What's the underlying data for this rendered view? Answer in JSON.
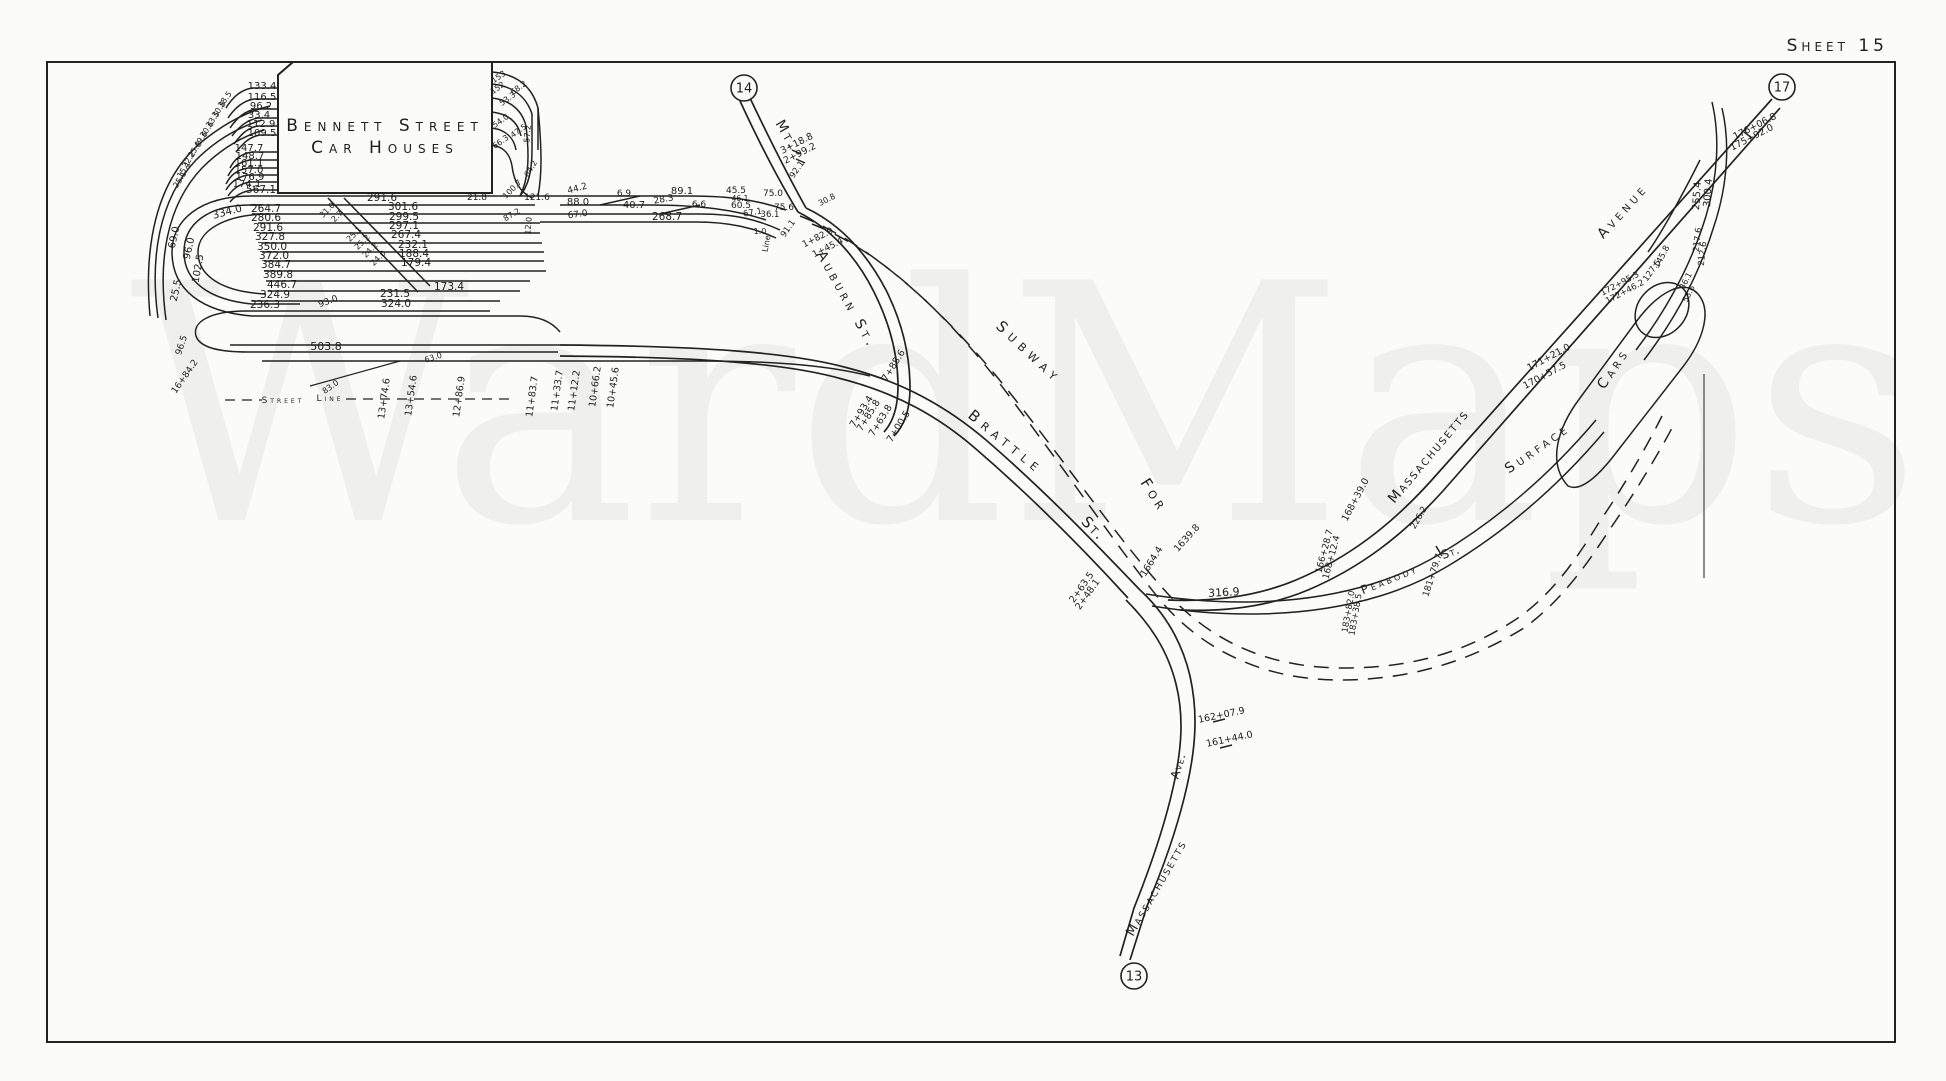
{
  "sheet": {
    "title": "Sheet 15"
  },
  "watermark": {
    "text": "WardMaps"
  },
  "building": {
    "line1": "Bennett Street",
    "line2": "Car Houses"
  },
  "colors": {
    "ink": "#222222",
    "paper": "#fbfbf9"
  },
  "ref_circles": [
    {
      "label": "14",
      "x": 744,
      "y": 88
    },
    {
      "label": "17",
      "x": 1782,
      "y": 87
    },
    {
      "label": "13",
      "x": 1134,
      "y": 976
    }
  ],
  "street_labels": [
    {
      "text": "Mt.",
      "x": 783,
      "y": 137,
      "r": 60,
      "s": 14,
      "ls": 3
    },
    {
      "text": "Auburn St.",
      "x": 843,
      "y": 302,
      "r": 61,
      "s": 14,
      "ls": 4
    },
    {
      "text": "Brattle",
      "x": 1003,
      "y": 446,
      "r": 39,
      "s": 15,
      "ls": 6
    },
    {
      "text": "St.",
      "x": 1090,
      "y": 532,
      "r": 45,
      "s": 15,
      "ls": 2
    },
    {
      "text": "Subway",
      "x": 1026,
      "y": 356,
      "r": 43,
      "s": 15,
      "ls": 6
    },
    {
      "text": "For",
      "x": 1150,
      "y": 498,
      "r": 57,
      "s": 15,
      "ls": 4
    },
    {
      "text": "Massachusetts",
      "x": 1432,
      "y": 459,
      "r": -50,
      "s": 14,
      "ls": 2
    },
    {
      "text": "Avenue",
      "x": 1626,
      "y": 214,
      "r": -48,
      "s": 14,
      "ls": 4
    },
    {
      "text": "Surface",
      "x": 1540,
      "y": 452,
      "r": -35,
      "s": 14,
      "ls": 4
    },
    {
      "text": "Cars",
      "x": 1617,
      "y": 371,
      "r": -56,
      "s": 14,
      "ls": 4
    },
    {
      "text": "Peabody",
      "x": 1391,
      "y": 583,
      "r": -22,
      "s": 12,
      "ls": 3
    },
    {
      "text": "St.",
      "x": 1452,
      "y": 556,
      "r": -20,
      "s": 12,
      "ls": 1
    },
    {
      "text": "Massachusetts",
      "x": 1160,
      "y": 890,
      "r": -60,
      "s": 13,
      "ls": 2
    },
    {
      "text": "Ave.",
      "x": 1182,
      "y": 767,
      "r": -73,
      "s": 12,
      "ls": 1
    },
    {
      "text": "Street",
      "x": 283,
      "y": 403,
      "r": 0,
      "s": 9,
      "ls": 3
    },
    {
      "text": "Line",
      "x": 330,
      "y": 401,
      "r": 0,
      "s": 9,
      "ls": 3
    }
  ],
  "measurements": [
    {
      "t": "49.6",
      "x": 203,
      "y": 141,
      "r": -55,
      "s": 8
    },
    {
      "t": "30.6",
      "x": 209,
      "y": 131,
      "r": -55,
      "s": 8
    },
    {
      "t": "33.5",
      "x": 215,
      "y": 121,
      "r": -55,
      "s": 8
    },
    {
      "t": "30.8",
      "x": 221,
      "y": 111,
      "r": -55,
      "s": 8
    },
    {
      "t": "38.5",
      "x": 227,
      "y": 101,
      "r": -55,
      "s": 8
    },
    {
      "t": "25.8",
      "x": 197,
      "y": 151,
      "r": -55,
      "s": 8
    },
    {
      "t": "22.2",
      "x": 191,
      "y": 161,
      "r": -58,
      "s": 8
    },
    {
      "t": "15.1",
      "x": 186,
      "y": 171,
      "r": -58,
      "s": 8
    },
    {
      "t": "25.1",
      "x": 182,
      "y": 181,
      "r": -58,
      "s": 8
    },
    {
      "t": "133.4",
      "x": 262,
      "y": 89,
      "s": 10
    },
    {
      "t": "116.5",
      "x": 262,
      "y": 100,
      "s": 10
    },
    {
      "t": "96.2",
      "x": 261,
      "y": 109,
      "s": 10
    },
    {
      "t": "33.4",
      "x": 259,
      "y": 118,
      "s": 10
    },
    {
      "t": "112.9",
      "x": 261,
      "y": 127,
      "s": 10
    },
    {
      "t": "109.5",
      "x": 262,
      "y": 136,
      "s": 10
    },
    {
      "t": "147.7",
      "x": 249,
      "y": 151,
      "s": 10
    },
    {
      "t": "148.7",
      "x": 250,
      "y": 159,
      "s": 10
    },
    {
      "t": "161.1",
      "x": 249,
      "y": 166,
      "s": 10
    },
    {
      "t": "157.0",
      "x": 249,
      "y": 173,
      "s": 10
    },
    {
      "t": "176.9",
      "x": 250,
      "y": 180,
      "s": 10
    },
    {
      "t": "174.1",
      "x": 247,
      "y": 187,
      "s": 10
    },
    {
      "t": "567.1",
      "x": 261,
      "y": 193,
      "s": 10.5
    },
    {
      "t": "291.6",
      "x": 382,
      "y": 201,
      "s": 10.5
    },
    {
      "t": "21.8",
      "x": 477,
      "y": 200,
      "s": 9
    },
    {
      "t": "334.0",
      "x": 228,
      "y": 215,
      "r": -15,
      "s": 10.5
    },
    {
      "t": "264.7",
      "x": 266,
      "y": 212,
      "s": 10.5
    },
    {
      "t": "280.6",
      "x": 266,
      "y": 221,
      "s": 10.5
    },
    {
      "t": "291.6",
      "x": 268,
      "y": 231,
      "s": 10.5
    },
    {
      "t": "327.8",
      "x": 270,
      "y": 240,
      "s": 10.5
    },
    {
      "t": "350.0",
      "x": 272,
      "y": 250,
      "s": 10.5
    },
    {
      "t": "372.0",
      "x": 274,
      "y": 259,
      "s": 10.5
    },
    {
      "t": "384.7",
      "x": 276,
      "y": 268,
      "s": 10.5
    },
    {
      "t": "389.8",
      "x": 278,
      "y": 278,
      "s": 10.5
    },
    {
      "t": "446.7",
      "x": 282,
      "y": 288,
      "s": 10.5
    },
    {
      "t": "324.9",
      "x": 275,
      "y": 298,
      "s": 10.5
    },
    {
      "t": "236.3",
      "x": 265,
      "y": 308,
      "s": 10.5
    },
    {
      "t": "301.6",
      "x": 403,
      "y": 210,
      "s": 10.5
    },
    {
      "t": "299.5",
      "x": 404,
      "y": 220,
      "s": 10.5
    },
    {
      "t": "297.1",
      "x": 404,
      "y": 229,
      "s": 10.5
    },
    {
      "t": "267.4",
      "x": 406,
      "y": 238,
      "s": 10.5
    },
    {
      "t": "232.1",
      "x": 413,
      "y": 248,
      "s": 10.5
    },
    {
      "t": "188.4",
      "x": 414,
      "y": 257,
      "s": 10.5
    },
    {
      "t": "179.4",
      "x": 416,
      "y": 266,
      "s": 10.5
    },
    {
      "t": "173.4",
      "x": 449,
      "y": 290,
      "s": 10.5
    },
    {
      "t": "231.5",
      "x": 395,
      "y": 297,
      "s": 10.5
    },
    {
      "t": "324.0",
      "x": 396,
      "y": 307,
      "s": 10.5
    },
    {
      "t": "31.0",
      "x": 329,
      "y": 212,
      "r": -45,
      "s": 8
    },
    {
      "t": "2.7",
      "x": 339,
      "y": 218,
      "r": -45,
      "s": 8
    },
    {
      "t": "25.1",
      "x": 356,
      "y": 236,
      "r": -45,
      "s": 8
    },
    {
      "t": "25.2",
      "x": 364,
      "y": 244,
      "r": -45,
      "s": 8
    },
    {
      "t": "24.2",
      "x": 372,
      "y": 252,
      "r": -45,
      "s": 8
    },
    {
      "t": "24.0",
      "x": 380,
      "y": 260,
      "r": -45,
      "s": 8
    },
    {
      "t": "93.0",
      "x": 329,
      "y": 304,
      "r": -20,
      "s": 9
    },
    {
      "t": "69.0",
      "x": 177,
      "y": 238,
      "r": -78,
      "s": 10
    },
    {
      "t": "96.0",
      "x": 192,
      "y": 249,
      "r": -78,
      "s": 10
    },
    {
      "t": "102.5",
      "x": 201,
      "y": 269,
      "r": -80,
      "s": 10
    },
    {
      "t": "25.5",
      "x": 179,
      "y": 291,
      "r": -78,
      "s": 10
    },
    {
      "t": "96.5",
      "x": 184,
      "y": 346,
      "r": -72,
      "s": 9
    },
    {
      "t": "16+84.2",
      "x": 187,
      "y": 378,
      "r": -55,
      "s": 9
    },
    {
      "t": "503.8",
      "x": 326,
      "y": 350,
      "s": 11
    },
    {
      "t": "83.0",
      "x": 332,
      "y": 389,
      "r": -35,
      "s": 8
    },
    {
      "t": "63.0",
      "x": 434,
      "y": 360,
      "r": -18,
      "s": 8
    },
    {
      "t": "13+74.6",
      "x": 387,
      "y": 399,
      "r": -82,
      "s": 9.5
    },
    {
      "t": "13+54.6",
      "x": 414,
      "y": 396,
      "r": -82,
      "s": 9.5
    },
    {
      "t": "12+86.9",
      "x": 462,
      "y": 397,
      "r": -82,
      "s": 9.5
    },
    {
      "t": "11+83.7",
      "x": 535,
      "y": 397,
      "r": -82,
      "s": 9.5
    },
    {
      "t": "11+33.7",
      "x": 560,
      "y": 391,
      "r": -82,
      "s": 9.5
    },
    {
      "t": "11+12.2",
      "x": 577,
      "y": 391,
      "r": -82,
      "s": 9.5
    },
    {
      "t": "10+66.2",
      "x": 598,
      "y": 387,
      "r": -82,
      "s": 9.5
    },
    {
      "t": "10+45.6",
      "x": 616,
      "y": 388,
      "r": -82,
      "s": 9.5
    },
    {
      "t": "153",
      "x": 500,
      "y": 79,
      "r": -35,
      "s": 8
    },
    {
      "t": "152",
      "x": 499,
      "y": 90,
      "r": -35,
      "s": 8
    },
    {
      "t": "68.2",
      "x": 520,
      "y": 90,
      "r": -35,
      "s": 8
    },
    {
      "t": "53.3",
      "x": 509,
      "y": 101,
      "r": -35,
      "s": 8
    },
    {
      "t": "54.0",
      "x": 502,
      "y": 123,
      "r": -35,
      "s": 8
    },
    {
      "t": "47.5",
      "x": 520,
      "y": 133,
      "r": -35,
      "s": 8
    },
    {
      "t": "66.3",
      "x": 502,
      "y": 144,
      "r": -35,
      "s": 8
    },
    {
      "t": "57.2",
      "x": 530,
      "y": 134,
      "r": -85,
      "s": 8
    },
    {
      "t": "64.2",
      "x": 533,
      "y": 170,
      "r": -60,
      "s": 8
    },
    {
      "t": "100.7",
      "x": 514,
      "y": 191,
      "r": -45,
      "s": 8
    },
    {
      "t": "121.6",
      "x": 537,
      "y": 200,
      "s": 9
    },
    {
      "t": "87.2",
      "x": 513,
      "y": 217,
      "r": -30,
      "s": 8
    },
    {
      "t": "12.0",
      "x": 531,
      "y": 226,
      "r": -85,
      "s": 8
    },
    {
      "t": "44.2",
      "x": 578,
      "y": 191,
      "r": -15,
      "s": 9
    },
    {
      "t": "6.9",
      "x": 624,
      "y": 196,
      "s": 9
    },
    {
      "t": "89.1",
      "x": 682,
      "y": 194,
      "s": 10
    },
    {
      "t": "88.0",
      "x": 578,
      "y": 205,
      "s": 10
    },
    {
      "t": "40.7",
      "x": 634,
      "y": 208,
      "s": 10
    },
    {
      "t": "28.3",
      "x": 664,
      "y": 202,
      "r": -10,
      "s": 9
    },
    {
      "t": "6.6",
      "x": 699,
      "y": 207,
      "s": 9
    },
    {
      "t": "268.7",
      "x": 667,
      "y": 220,
      "s": 10.5
    },
    {
      "t": "67.0",
      "x": 578,
      "y": 217,
      "r": -8,
      "s": 9
    },
    {
      "t": "45.5",
      "x": 736,
      "y": 193,
      "s": 9
    },
    {
      "t": "46.1",
      "x": 740,
      "y": 201,
      "s": 7.5
    },
    {
      "t": "60.5",
      "x": 741,
      "y": 208,
      "s": 9
    },
    {
      "t": "75.0",
      "x": 773,
      "y": 196,
      "s": 9
    },
    {
      "t": "75.6",
      "x": 784,
      "y": 210,
      "s": 9
    },
    {
      "t": "36.1",
      "x": 770,
      "y": 217,
      "s": 8.5
    },
    {
      "t": "67.1",
      "x": 753,
      "y": 215,
      "r": -10,
      "s": 8.5
    },
    {
      "t": "1.0",
      "x": 760,
      "y": 234,
      "s": 8
    },
    {
      "t": "92.1",
      "x": 799,
      "y": 171,
      "r": -55,
      "s": 8.5
    },
    {
      "t": "91.1",
      "x": 790,
      "y": 230,
      "r": -55,
      "s": 8.5
    },
    {
      "t": "Line",
      "x": 769,
      "y": 244,
      "r": -80,
      "s": 8
    },
    {
      "t": "3+18.8",
      "x": 798,
      "y": 146,
      "r": -27,
      "s": 9.5
    },
    {
      "t": "2+99.2",
      "x": 801,
      "y": 156,
      "r": -27,
      "s": 9.5
    },
    {
      "t": "30.8",
      "x": 828,
      "y": 202,
      "r": -27,
      "s": 8
    },
    {
      "t": "1+82.9",
      "x": 819,
      "y": 240,
      "r": -27,
      "s": 9
    },
    {
      "t": "1+45.4",
      "x": 829,
      "y": 250,
      "r": -27,
      "s": 9
    },
    {
      "t": "7+88.6",
      "x": 896,
      "y": 367,
      "r": -58,
      "s": 9.5
    },
    {
      "t": "7+93.4",
      "x": 864,
      "y": 413,
      "r": -58,
      "s": 9.5
    },
    {
      "t": "7+85.8",
      "x": 871,
      "y": 417,
      "r": -58,
      "s": 9.5
    },
    {
      "t": "7+63.8",
      "x": 883,
      "y": 422,
      "r": -58,
      "s": 9.5
    },
    {
      "t": "7+00.5",
      "x": 901,
      "y": 428,
      "r": -58,
      "s": 9.5
    },
    {
      "t": "2+63.5",
      "x": 1084,
      "y": 589,
      "r": -55,
      "s": 9.5
    },
    {
      "t": "2+48.1",
      "x": 1090,
      "y": 596,
      "r": -55,
      "s": 9.5
    },
    {
      "t": "316.9",
      "x": 1224,
      "y": 596,
      "r": -3,
      "s": 11
    },
    {
      "t": "1664.4",
      "x": 1154,
      "y": 563,
      "r": -58,
      "s": 9.5
    },
    {
      "t": "1639.8",
      "x": 1189,
      "y": 540,
      "r": -48,
      "s": 9.5
    },
    {
      "t": "162+07.9",
      "x": 1222,
      "y": 718,
      "r": -12,
      "s": 9.5
    },
    {
      "t": "161+44.0",
      "x": 1230,
      "y": 742,
      "r": -12,
      "s": 9.5
    },
    {
      "t": "168+39.0",
      "x": 1358,
      "y": 501,
      "r": -62,
      "s": 9.5
    },
    {
      "t": "166+28.7",
      "x": 1327,
      "y": 552,
      "r": -75,
      "s": 9
    },
    {
      "t": "168+12.4",
      "x": 1334,
      "y": 558,
      "r": -75,
      "s": 9
    },
    {
      "t": "181+79.7",
      "x": 1435,
      "y": 576,
      "r": -72,
      "s": 9
    },
    {
      "t": "183+82.0",
      "x": 1351,
      "y": 612,
      "r": -80,
      "s": 8.5
    },
    {
      "t": "183+38.5",
      "x": 1358,
      "y": 615,
      "r": -80,
      "s": 8.5
    },
    {
      "t": "226.2",
      "x": 1421,
      "y": 519,
      "r": -60,
      "s": 8.5
    },
    {
      "t": "171+21.0",
      "x": 1550,
      "y": 360,
      "r": -28,
      "s": 9.5
    },
    {
      "t": "170+57.5",
      "x": 1546,
      "y": 378,
      "r": -28,
      "s": 9.5
    },
    {
      "t": "172+95.3",
      "x": 1621,
      "y": 286,
      "r": -28,
      "s": 8.5
    },
    {
      "t": "172+46.2",
      "x": 1626,
      "y": 294,
      "r": -28,
      "s": 8.5
    },
    {
      "t": "145.8",
      "x": 1664,
      "y": 258,
      "r": -62,
      "s": 8.5
    },
    {
      "t": "127.5",
      "x": 1654,
      "y": 272,
      "r": -55,
      "s": 8.5
    },
    {
      "t": "36.1",
      "x": 1688,
      "y": 282,
      "r": -62,
      "s": 8
    },
    {
      "t": "53.6",
      "x": 1691,
      "y": 295,
      "r": -62,
      "s": 8
    },
    {
      "t": "217.6",
      "x": 1700,
      "y": 240,
      "r": -84,
      "s": 8.5
    },
    {
      "t": "212.6",
      "x": 1705,
      "y": 254,
      "r": -84,
      "s": 8.5
    },
    {
      "t": "255.4",
      "x": 1700,
      "y": 196,
      "r": -86,
      "s": 10
    },
    {
      "t": "300.4",
      "x": 1711,
      "y": 193,
      "r": -86,
      "s": 10
    },
    {
      "t": "176+06.8",
      "x": 1756,
      "y": 129,
      "r": -27,
      "s": 9.5
    },
    {
      "t": "175+92.0",
      "x": 1753,
      "y": 140,
      "r": -27,
      "s": 9.5
    }
  ]
}
